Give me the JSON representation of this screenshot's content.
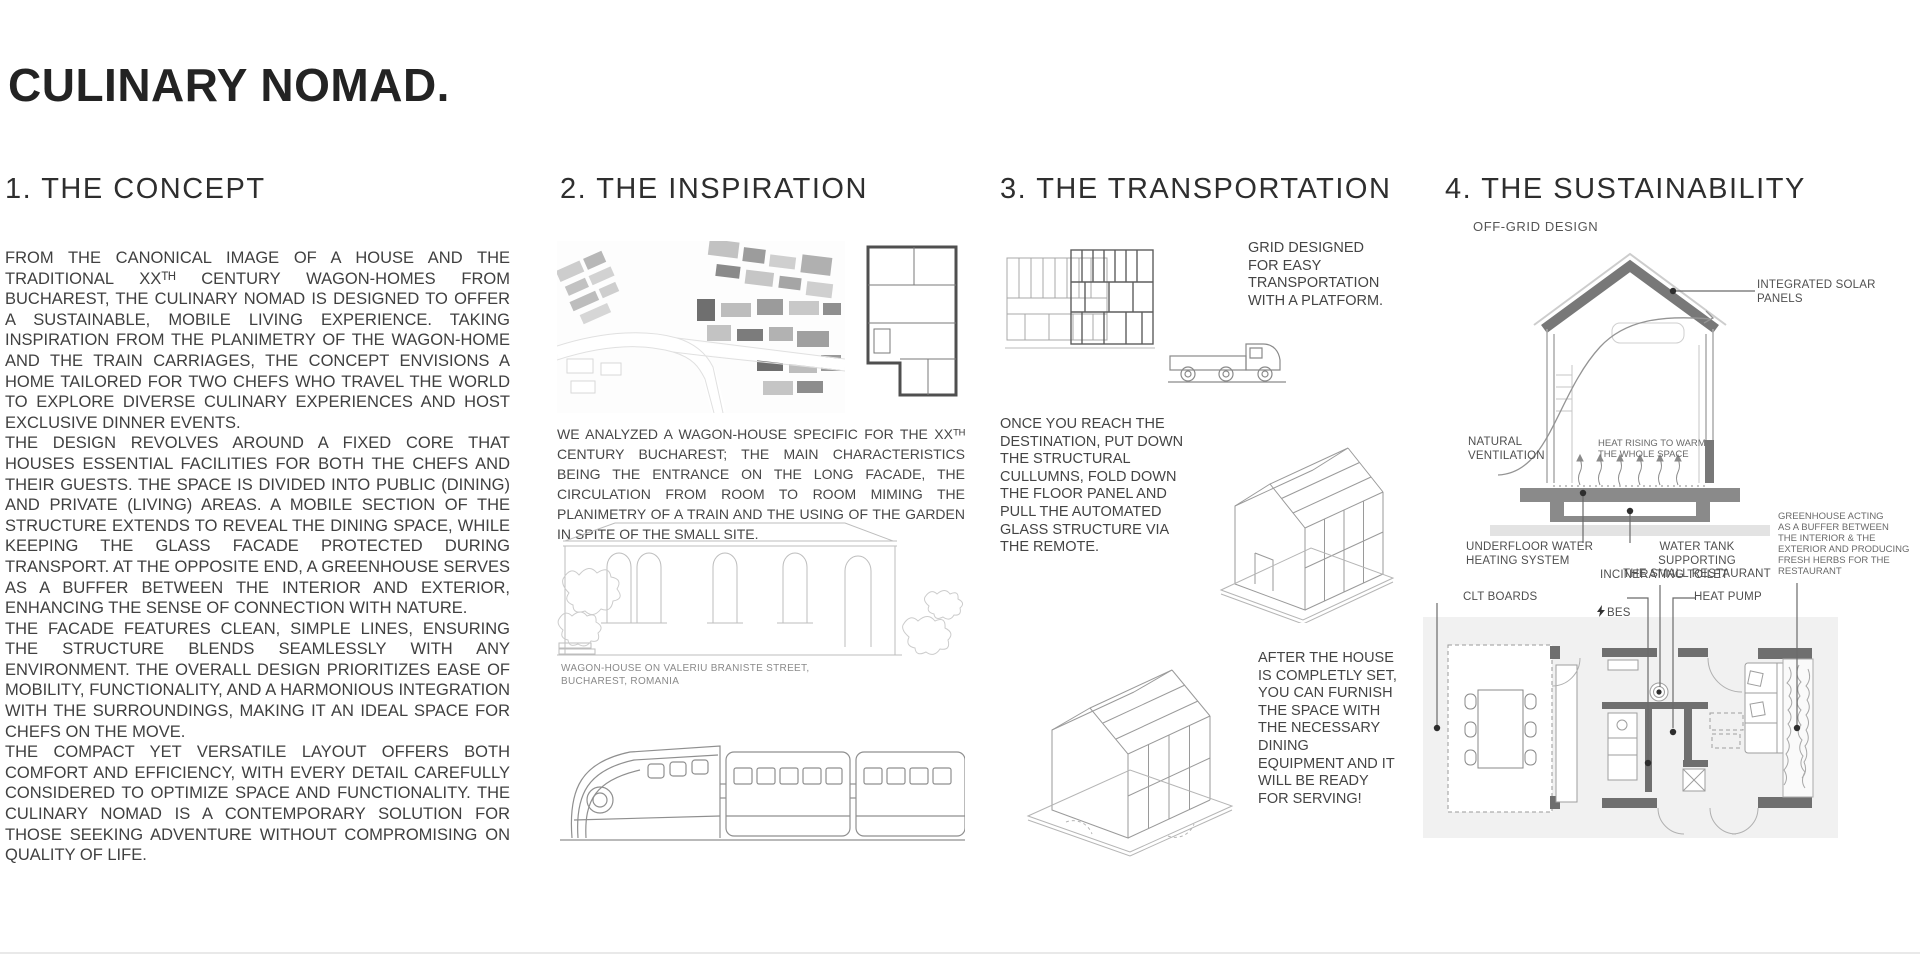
{
  "title": "CULINARY NOMAD.",
  "concept": {
    "heading": "1. THE CONCEPT",
    "paragraphs": [
      "FROM THE CANONICAL IMAGE OF A HOUSE AND THE TRADITIONAL XXᵀᴴ CENTURY WAGON-HOMES FROM BUCHAREST, THE CULINARY NOMAD IS DESIGNED TO OFFER A SUSTAINABLE, MOBILE LIVING EXPERIENCE. TAKING INSPIRATION FROM THE PLANIMETRY OF THE WAGON-HOME AND THE TRAIN CARRIAGES, THE CONCEPT ENVISIONS A HOME TAILORED FOR TWO CHEFS WHO TRAVEL THE WORLD TO EXPLORE DIVERSE CULINARY EXPERIENCES AND HOST EXCLUSIVE DINNER EVENTS.",
      "THE DESIGN REVOLVES AROUND A FIXED CORE THAT HOUSES ESSENTIAL FACILITIES FOR BOTH THE CHEFS AND THEIR GUESTS. THE SPACE IS DIVIDED INTO PUBLIC (DINING) AND PRIVATE (LIVING) AREAS. A MOBILE SECTION OF THE STRUCTURE EXTENDS TO REVEAL THE DINING SPACE, WHILE KEEPING THE GLASS FACADE PROTECTED DURING TRANSPORT. AT THE OPPOSITE END, A GREENHOUSE SERVES AS A BUFFER BETWEEN THE INTERIOR AND EXTERIOR, ENHANCING THE SENSE OF CONNECTION WITH NATURE.",
      "THE FACADE FEATURES CLEAN, SIMPLE LINES, ENSURING THE STRUCTURE BLENDS SEAMLESSLY WITH ANY ENVIRONMENT. THE OVERALL DESIGN PRIORITIZES EASE OF MOBILITY, FUNCTIONALITY, AND A HARMONIOUS INTEGRATION WITH THE SURROUNDINGS, MAKING IT AN IDEAL SPACE FOR CHEFS ON THE MOVE.",
      "THE COMPACT YET VERSATILE LAYOUT OFFERS BOTH COMFORT AND EFFICIENCY, WITH EVERY DETAIL CAREFULLY CONSIDERED TO OPTIMIZE SPACE AND FUNCTIONALITY. THE CULINARY NOMAD IS A CONTEMPORARY SOLUTION FOR THOSE SEEKING ADVENTURE WITHOUT COMPROMISING ON QUALITY OF LIFE."
    ]
  },
  "inspiration": {
    "heading": "2. THE INSPIRATION",
    "analysis": "WE ANALYZED A WAGON-HOUSE SPECIFIC FOR THE XXᵀᴴ CENTURY BUCHAREST; THE MAIN CHARACTERISTICS BEING THE ENTRANCE ON THE LONG FACADE, THE CIRCULATION FROM ROOM TO ROOM MIMING THE PLANIMETRY OF A TRAIN AND THE USING OF THE GARDEN IN SPITE OF THE SMALL SITE.",
    "photo_caption": "WAGON-HOUSE ON VALERIU BRANISTE STREET,\nBUCHAREST, ROMANIA"
  },
  "transportation": {
    "heading": "3. THE TRANSPORTATION",
    "step1": "GRID DESIGNED\nFOR EASY\nTRANSPORTATION\nWITH A PLATFORM.",
    "step2": "ONCE YOU REACH THE\nDESTINATION, PUT DOWN\nTHE STRUCTURAL\nCULLUMNS, FOLD DOWN\nTHE FLOOR PANEL AND\nPULL THE AUTOMATED\nGLASS STRUCTURE VIA\nTHE REMOTE.",
    "step3": "AFTER THE HOUSE\nIS COMPLETLY SET,\nYOU CAN FURNISH\nTHE SPACE WITH\nTHE NECESSARY\nDINING\nEQUIPMENT AND IT\nWILL BE READY\nFOR SERVING!"
  },
  "sustainability": {
    "heading": "4. THE SUSTAINABILITY",
    "subtitle": "OFF-GRID DESIGN",
    "labels": {
      "solar_panels": "INTEGRATED SOLAR PANELS",
      "natural_ventilation": "NATURAL\nVENTILATION",
      "heat_rising": "HEAT RISING TO WARM\nTHE WHOLE SPACE",
      "underfloor": "UNDERFLOOR WATER\nHEATING SYSTEM",
      "water_tank": "WATER TANK SUPPORTING\nTHE SMALL RESTAURANT",
      "incinerating_toilet": "INCINERATING TOILET",
      "greenhouse": "GREENHOUSE ACTING\nAS A BUFFER BETWEEN\nTHE INTERIOR & THE\nEXTERIOR AND PRODUCING\nFRESH HERBS FOR THE\nRESTAURANT",
      "clt_boards": "CLT BOARDS",
      "bes": "BES",
      "heat_pump": "HEAT PUMP"
    }
  },
  "colors": {
    "ink": "#232323",
    "body_text": "#404040",
    "drawing_line": "#9a9a9a",
    "drawing_dark": "#787878",
    "panel_bg": "#f1f1f1"
  }
}
